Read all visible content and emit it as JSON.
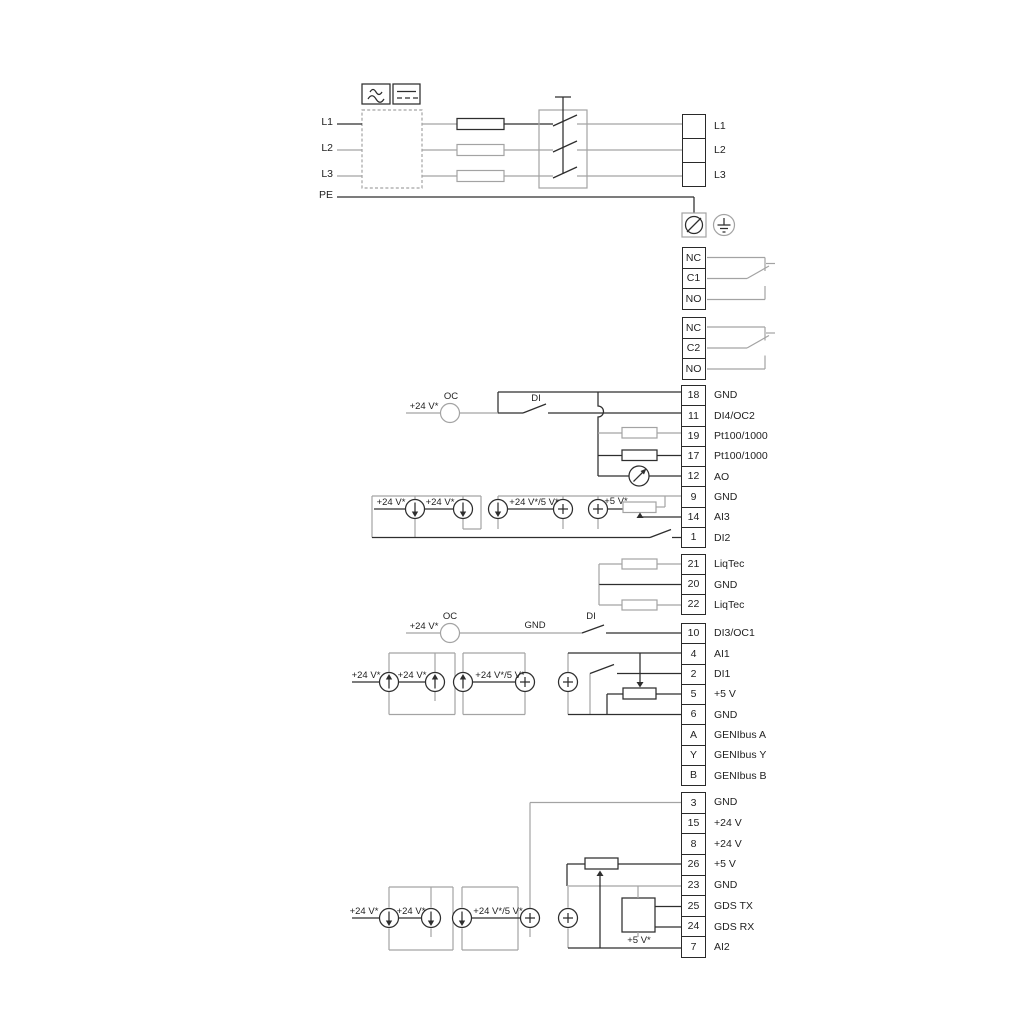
{
  "diagram_type": "pump drive terminal wiring diagram",
  "inputs": [
    "L1",
    "L2",
    "L3",
    "PE"
  ],
  "blocks": {
    "power": {
      "rows": [
        {
          "l": "L1"
        },
        {
          "l": "L2"
        },
        {
          "l": "L3"
        }
      ]
    },
    "relay1": {
      "rows": [
        {
          "n": "NC"
        },
        {
          "n": "C1"
        },
        {
          "n": "NO"
        }
      ]
    },
    "relay2": {
      "rows": [
        {
          "n": "NC"
        },
        {
          "n": "C2"
        },
        {
          "n": "NO"
        }
      ]
    },
    "io1": {
      "rows": [
        {
          "n": "18",
          "l": "GND"
        },
        {
          "n": "11",
          "l": "DI4/OC2"
        },
        {
          "n": "19",
          "l": "Pt100/1000"
        },
        {
          "n": "17",
          "l": "Pt100/1000"
        },
        {
          "n": "12",
          "l": "AO"
        },
        {
          "n": "9",
          "l": "GND"
        },
        {
          "n": "14",
          "l": "AI3"
        },
        {
          "n": "1",
          "l": "DI2"
        }
      ]
    },
    "liqtec": {
      "rows": [
        {
          "n": "21",
          "l": "LiqTec"
        },
        {
          "n": "20",
          "l": "GND"
        },
        {
          "n": "22",
          "l": "LiqTec"
        }
      ]
    },
    "io2": {
      "rows": [
        {
          "n": "10",
          "l": "DI3/OC1"
        },
        {
          "n": "4",
          "l": "AI1"
        },
        {
          "n": "2",
          "l": "DI1"
        },
        {
          "n": "5",
          "l": "+5 V"
        },
        {
          "n": "6",
          "l": "GND"
        },
        {
          "n": "A",
          "l": "GENIbus A"
        },
        {
          "n": "Y",
          "l": "GENIbus Y"
        },
        {
          "n": "B",
          "l": "GENIbus B"
        }
      ]
    },
    "io3": {
      "rows": [
        {
          "n": "3",
          "l": "GND"
        },
        {
          "n": "15",
          "l": "+24 V"
        },
        {
          "n": "8",
          "l": "+24 V"
        },
        {
          "n": "26",
          "l": "+5 V"
        },
        {
          "n": "23",
          "l": "GND"
        },
        {
          "n": "25",
          "l": "GDS TX"
        },
        {
          "n": "24",
          "l": "GDS RX"
        },
        {
          "n": "7",
          "l": "AI2"
        }
      ]
    }
  },
  "ann": {
    "v24": "+24 V*",
    "v24_5": "+24 V*/5 V*",
    "v5": "+5 V*",
    "oc": "OC",
    "di": "DI",
    "gnd": "GND"
  },
  "colors": {
    "wire": "#2e2e2e",
    "wire_gray": "#a3a3a3",
    "background": "#ffffff"
  }
}
